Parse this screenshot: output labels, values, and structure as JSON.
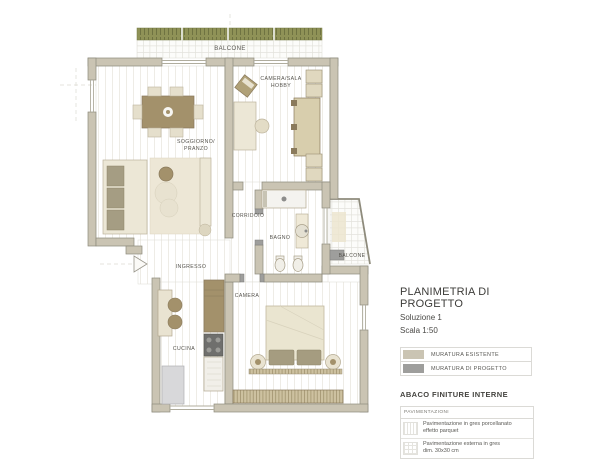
{
  "plan": {
    "rooms": {
      "balcone_top": "BALCONE",
      "camera_hobby_line1": "CAMERA/SALA",
      "camera_hobby_line2": "HOBBY",
      "soggiorno_line1": "SOGGIORNO/",
      "soggiorno_line2": "PRANZO",
      "corridoio": "CORRIDOIO",
      "bagno": "BAGNO",
      "balcone_right": "BALCONE",
      "ingresso": "INGRESSO",
      "camera": "CAMERA",
      "cucina": "CUCINA"
    },
    "colors": {
      "wall_existing": "#cac4b3",
      "wall_new": "#9e9e9c",
      "furniture_light": "#ece7d6",
      "furniture_brown": "#a3916b",
      "railing_green": "#8f9257",
      "floor_line": "#eceae4"
    }
  },
  "panel": {
    "title": "PLANIMETRIA DI PROGETTO",
    "subtitle": "Soluzione 1",
    "scale": "Scala 1:50",
    "legend": [
      {
        "label": "MURATURA ESISTENTE",
        "color": "#cac4b3"
      },
      {
        "label": "MURATURA DI PROGETTO",
        "color": "#9e9e9c"
      }
    ],
    "finishes_heading": "ABACO FINITURE INTERNE",
    "finishes_table": {
      "header": "PAVIMENTAZIONI",
      "rows": [
        {
          "line1": "Pavimentazione in gres porcellanato",
          "line2": "effetto parquet",
          "swatch": "parquet-lines"
        },
        {
          "line1": "Pavimentazione esterna in gres",
          "line2": "dim. 30x30 cm",
          "swatch": "tile-grid"
        }
      ]
    }
  }
}
